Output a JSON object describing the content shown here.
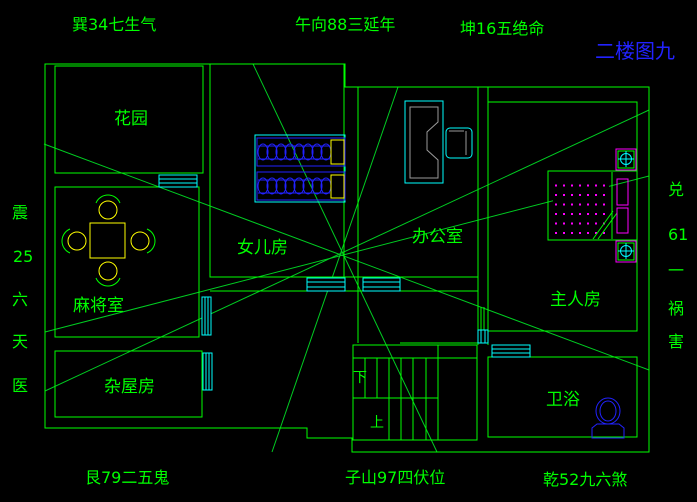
{
  "drawing_title": "二楼图九",
  "compass": {
    "top_left": "巽34七生气",
    "top_center": "午向88三延年",
    "top_right": "坤16五绝命",
    "bottom_left": "艮79二五鬼",
    "bottom_center": "子山97四伏位",
    "bottom_right": "乾52九六煞",
    "left": [
      "震",
      "25",
      "六",
      "天",
      "医"
    ],
    "right": [
      "兑",
      "61",
      "一",
      "祸",
      "害"
    ]
  },
  "rooms": {
    "garden": "花园",
    "daughter": "女儿房",
    "office": "办公室",
    "mahjong": "麻将室",
    "master": "主人房",
    "storage": "杂屋房",
    "bathroom": "卫浴"
  },
  "stairs": {
    "down": "下",
    "up": "上"
  },
  "colors": {
    "background": "#000000",
    "wall_green": "#00ff00",
    "window_cyan": "#00ffff",
    "furniture_yellow": "#ffff00",
    "bed_blue": "#2222ff",
    "accent_magenta": "#ff00ff",
    "desk_gray": "#9a9a9a",
    "title_blue": "#2222ff"
  }
}
